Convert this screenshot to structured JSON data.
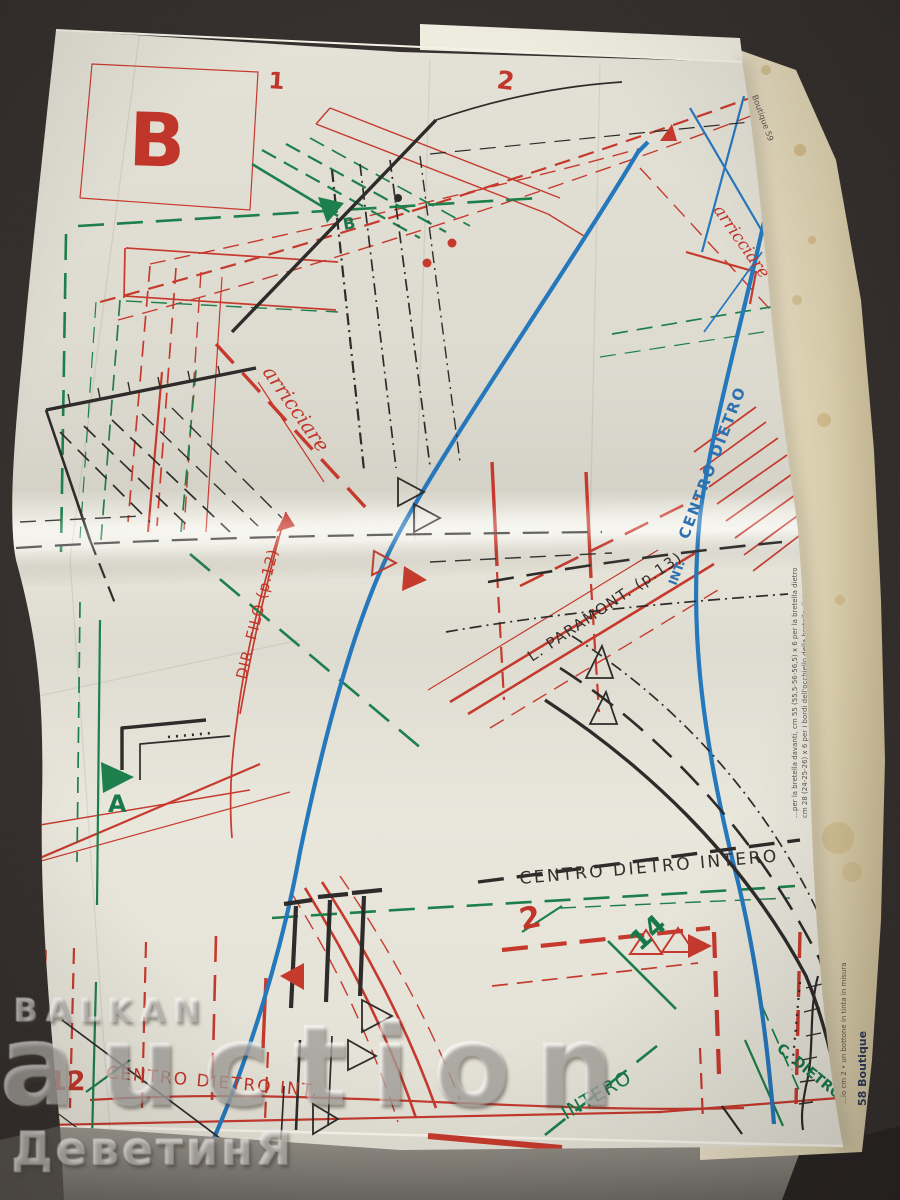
{
  "photo": {
    "background_color": "#2e2927"
  },
  "palette": {
    "red": "#c63a2e",
    "green": "#1d7f4b",
    "blue": "#2678bd",
    "black": "#2e2c2a",
    "page": "#e8e6db",
    "underpage": "#e0d6bb"
  },
  "sheet": {
    "view_letter": "B",
    "numbers": {
      "top_left": "1",
      "top_center": "2",
      "top_right": "3",
      "bottom_left": "12",
      "bottom_center": "2",
      "bottom_right": "14"
    },
    "size_markers": {
      "a": "A",
      "b": "B"
    },
    "labels": {
      "arricciare_top": "arricciare",
      "arricciare_mid": "arricciare",
      "dir_filo": "DIR. FILO (p.12)",
      "paramont": "L. PARAMONT. (p.13)",
      "centro_dietro_prefix": "INT.",
      "centro_dietro_blue": "CENTRO DIETRO",
      "centro_dietro_intero": "CENTRO DIETRO INTERO",
      "centro_dietro_int": "CENTRO DIETRO INT.",
      "intero": "INTERO",
      "c_dietro": "C. DIETRO"
    },
    "margins": {
      "page_top": "Boutique 59",
      "page_bottom": "58 Boutique",
      "note_1": "…per la bretella davanti, cm 55 (55,5-56-56,5) x 6 per la bretella dietro",
      "note_2": "cm 28 (24-25-26) x 6 per i bordi dell'occhiello della bretella dietro",
      "note_3": "…io cm 2 • un bottone in tinta in misura"
    }
  },
  "watermark": {
    "brand": "BALKAN",
    "brand2": "auction",
    "site": "ДеветинЯ"
  }
}
